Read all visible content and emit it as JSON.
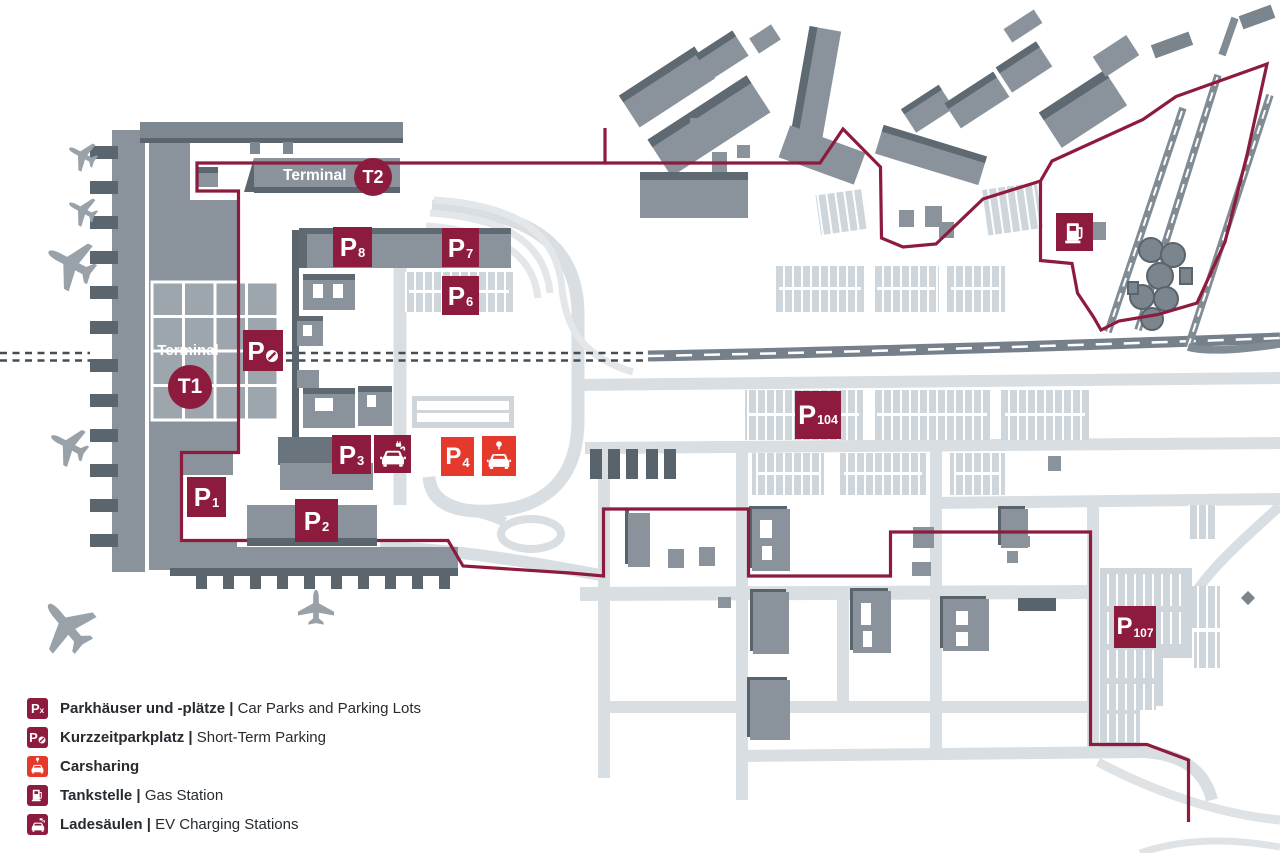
{
  "colors": {
    "maroon": "#8d1b3d",
    "red": "#e5392b",
    "building": "#8a939b",
    "road": "#d9dee2",
    "text": "#262b30"
  },
  "terminals": {
    "t1": {
      "label": "Terminal",
      "code": "T1"
    },
    "t2": {
      "label": "Terminal",
      "code": "T2"
    }
  },
  "parking_badges": {
    "po": {
      "p": "P"
    },
    "p1": {
      "p": "P",
      "sub": "1"
    },
    "p2": {
      "p": "P",
      "sub": "2"
    },
    "p3": {
      "p": "P",
      "sub": "3"
    },
    "p4": {
      "p": "P",
      "sub": "4"
    },
    "p6": {
      "p": "P",
      "sub": "6"
    },
    "p7": {
      "p": "P",
      "sub": "7"
    },
    "p8": {
      "p": "P",
      "sub": "8"
    },
    "p104": {
      "p": "P",
      "sub": "104"
    },
    "p107": {
      "p": "P",
      "sub": "107"
    }
  },
  "legend": {
    "rows": [
      {
        "badge_p": "P",
        "badge_sub": "x",
        "de": "Parkhäuser und -plätze",
        "sep": " | ",
        "en": "Car Parks and Parking Lots"
      },
      {
        "badge_p": "P",
        "de": "Kurzzeitparkplatz",
        "sep": " | ",
        "en": "Short-Term Parking"
      },
      {
        "de": "Carsharing",
        "sep": "",
        "en": ""
      },
      {
        "de": "Tankstelle",
        "sep": " | ",
        "en": "Gas Station"
      },
      {
        "de": "Ladesäulen",
        "sep": " | ",
        "en": "EV Charging Stations"
      }
    ]
  }
}
